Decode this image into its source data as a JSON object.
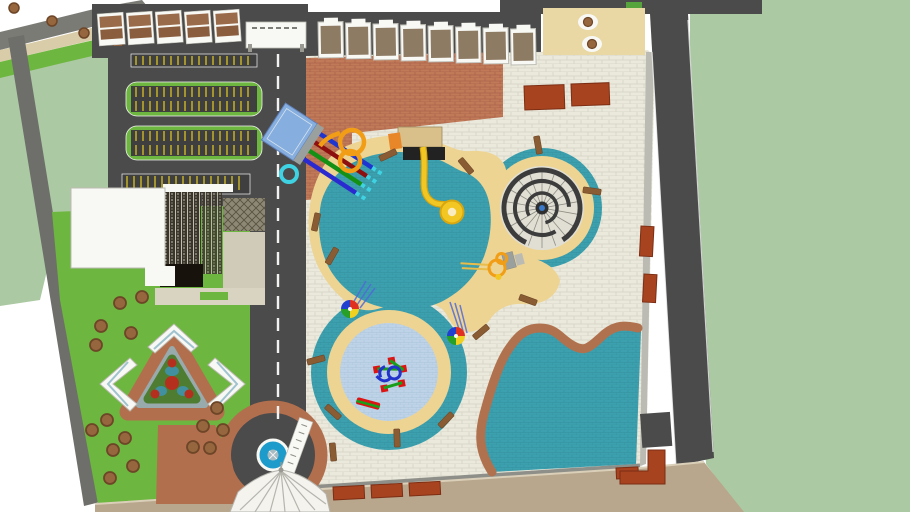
{
  "scene": {
    "type": "aerial-3d-site-plan",
    "subject": "water park master plan render"
  },
  "counts": {
    "cabanas": 8,
    "entry_houses": 5,
    "parking_rows": 4,
    "garden_canopies": 3,
    "bottom_planters": 3,
    "racer_lanes": 4
  },
  "colors": {
    "page_bg": "#ffffff",
    "sage": "#abc9a2",
    "lawn": "#6db63f",
    "asphalt": "#4b4b4b",
    "road_mid": "#7b7b76",
    "boundary_road": "#6e6e6a",
    "curb_light": "#bcbbb3",
    "curb_gray": "#8f8f89",
    "tile_base": "#eae9dc",
    "tile_line": "#d4d3c4",
    "terra_base": "#c17a58",
    "terra_line": "#a9624a",
    "tan_area": "#e9d7a4",
    "sand": "#edd493",
    "teal": "#3da0af",
    "teal_line": "#35909e",
    "kiddie": "#bed3e7",
    "kiddie_line": "#aac3da",
    "wave_border": "#b0714e",
    "brick_red": "#a8431f",
    "brick_dark": "#7c2e14",
    "white_struct": "#f8f8f4",
    "taupe": "#8d7b64",
    "roof_dark": "#3a362b",
    "roof_stripe_line": "#d0cdbd",
    "roof_mid": "#57523f",
    "lattice_base": "#8d8776",
    "lattice_line": "#57533f",
    "patio": "#d0cbb9",
    "patio2": "#d9d4c2",
    "black_roof": "#17130c",
    "stone": "#d9cda9",
    "dirt": "#b8a78c",
    "dirt_edge": "#dacfb8",
    "yellow": "#f3c723",
    "yellow_dark": "#d8a60e",
    "donut_hole": "#f8ecc0",
    "orange": "#f29d16",
    "orange_lt": "#e9bd4b",
    "cyan": "#3fd2e2",
    "platform": "#86aede",
    "platform_edge": "#5f7fb8",
    "gray_pad": "#9aa09e",
    "lane_blue": "#1f35cf",
    "lane_red": "#8d0f0f",
    "lane_green": "#149114",
    "lane_navy": "#2a2ad0",
    "streak_blue": "#5068d8",
    "fountain": "#1d9bca",
    "fountain_core": "#a7bcc2",
    "tree": "#96663e",
    "tree_dark": "#6d4527",
    "bench": "#8a5c33",
    "bench_dark": "#6e4626",
    "flower": "#b52f1f",
    "plant": "#4e7d32",
    "pond": "#4090a0",
    "garden_ring": "#b26f4e",
    "garden_pale": "#e3dccb",
    "gray_ring": "#98aaab",
    "canopy_glass": "#9fc3cf",
    "spiral_dark": "#3c3c3c",
    "spiral_ground": "#e1dfd3",
    "spoke": "#8c8c85",
    "white_line": "#f2f2f2",
    "stripe_yellow": "#d9c226",
    "stall_dark": "#3f3f3f",
    "tent": "#f4f3ee",
    "rib": "#b5b5ae",
    "play_red": "#dd1414",
    "play_green": "#1a9e1a",
    "play_blue": "#2233cc",
    "umb_red": "#e03020",
    "umb_yellow": "#f0d020",
    "umb_green": "#28a028",
    "umb_blue": "#2040d0",
    "orange_step": "#e8862a",
    "deck_tan": "#d9bf8a",
    "deck_edge": "#9a8a60",
    "house_roof": "#9a6b4a",
    "house_roof2": "#8a5d3e",
    "sign_dark": "#555550",
    "gate_post": "#999992",
    "black": "#222222",
    "green_patch": "#57a33c",
    "hub_blue": "#3a78c8",
    "hub_dark": "#2f2f2f"
  }
}
